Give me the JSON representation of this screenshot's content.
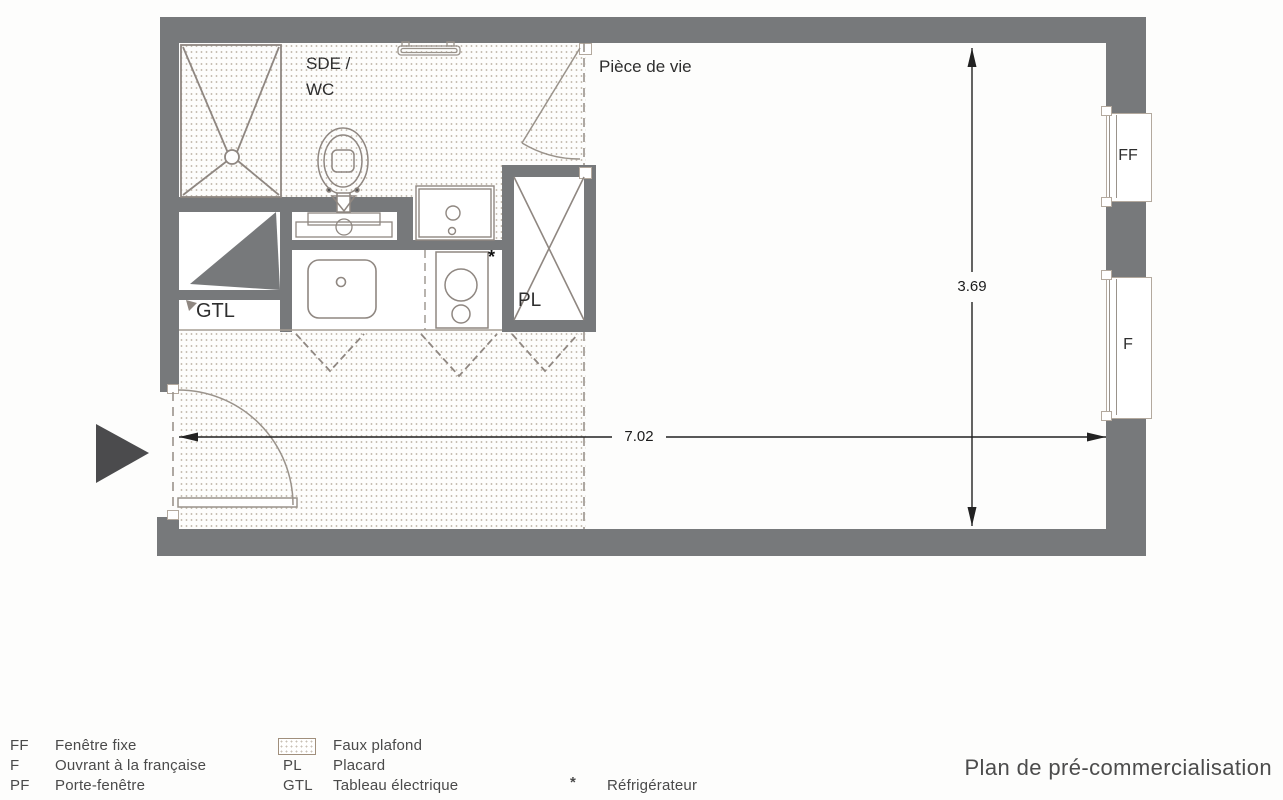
{
  "title": "Plan de pré-commercialisation",
  "plan": {
    "room_labels": {
      "bathroom_line1": "SDE /",
      "bathroom_line2": "WC",
      "living_room": "Pièce de vie",
      "closet": "PL",
      "electrical": "GTL"
    },
    "window_labels": {
      "fixed": "FF",
      "french": "F"
    },
    "dimensions": {
      "width_m": "7.02",
      "depth_m": "3.69"
    },
    "fridge_marker": "*"
  },
  "legend": {
    "col1": [
      {
        "abbr": "FF",
        "label": "Fenêtre fixe"
      },
      {
        "abbr": "F",
        "label": "Ouvrant à la française"
      },
      {
        "abbr": "PF",
        "label": "Porte-fenêtre"
      }
    ],
    "col2": {
      "swatch_label": "Faux plafond",
      "rows": [
        {
          "abbr": "PL",
          "label": "Placard"
        },
        {
          "abbr": "GTL",
          "label": "Tableau électrique"
        }
      ]
    },
    "col3": [
      {
        "abbr": "*",
        "label": "Réfrigérateur"
      }
    ]
  },
  "colors": {
    "wall": "#77797b",
    "fixture_line": "#8f8781",
    "dimension": "#1c1c1c",
    "entrance_arrow": "#4b4b4d",
    "legend_text": "#4a4a4a",
    "ceiling_dots": "#96826c"
  }
}
